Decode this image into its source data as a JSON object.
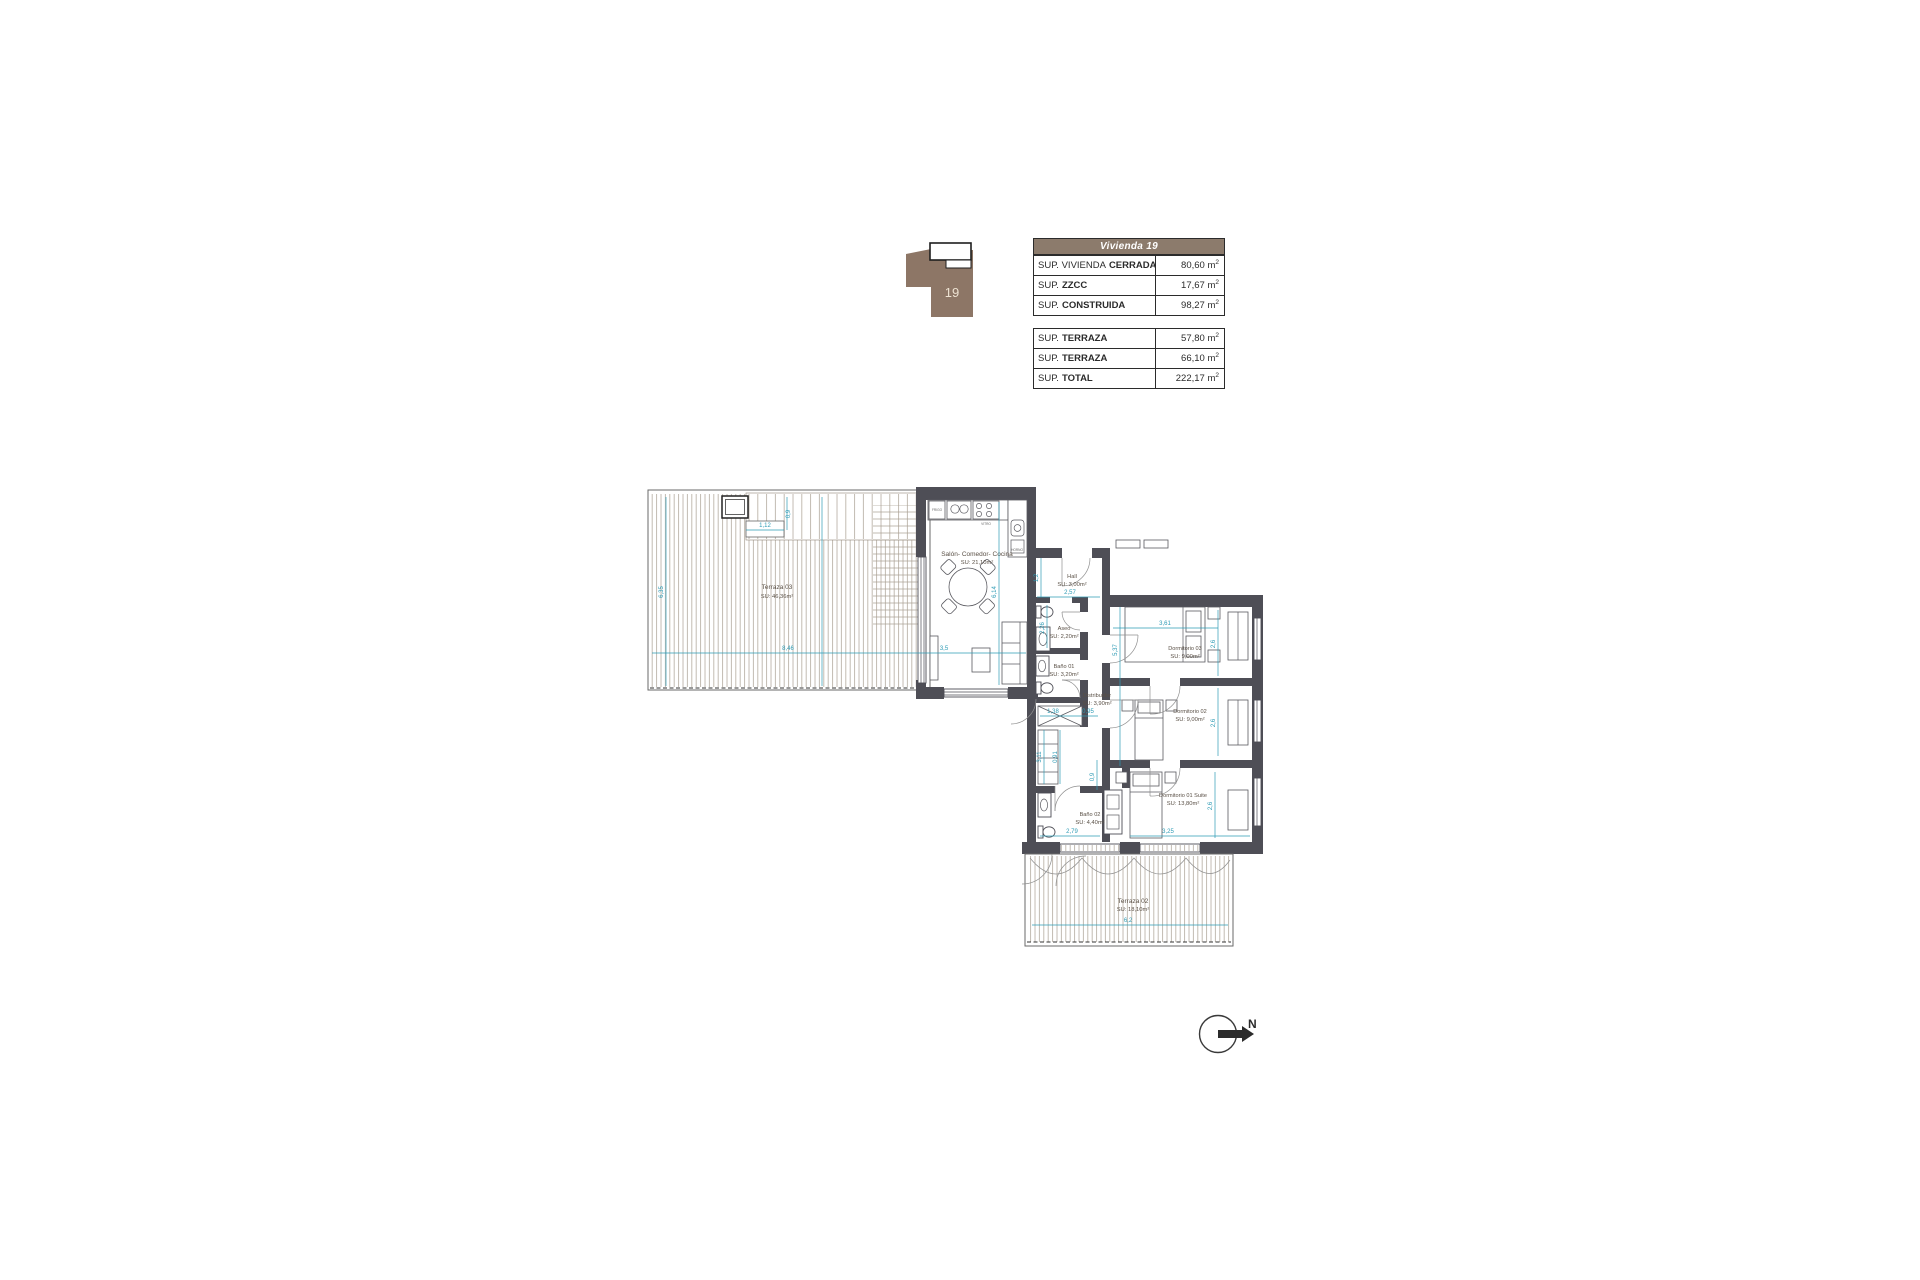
{
  "colors": {
    "header_brown": "#8C7B6C",
    "keyplan_brown": "#8D7666",
    "wall_gray": "#4E4E56",
    "dimension_teal": "#2E9BB5"
  },
  "key_plan": {
    "unit": "19"
  },
  "tables": {
    "main": {
      "header": "Vivienda 19",
      "rows": [
        {
          "label": "SUP. VIVIENDA",
          "label_bold": "CERRADA",
          "value": "80,60 m",
          "exp": "2"
        },
        {
          "label": "SUP.",
          "label_bold": "ZZCC",
          "value": "17,67 m",
          "exp": "2"
        },
        {
          "label": "SUP.",
          "label_bold": "CONSTRUIDA",
          "value": "98,27 m",
          "exp": "2"
        }
      ]
    },
    "terraces": {
      "rows": [
        {
          "label": "SUP.",
          "label_bold": "TERRAZA",
          "value": "57,80 m",
          "exp": "2"
        },
        {
          "label": "SUP.",
          "label_bold": "TERRAZA",
          "value": "66,10 m",
          "exp": "2"
        },
        {
          "label": "SUP.",
          "label_bold": "TOTAL",
          "value": "222,17 m",
          "exp": "2"
        }
      ]
    }
  },
  "floor_plan": {
    "rooms": [
      {
        "name": "Terraza 03",
        "area": "SU: 46,36m²"
      },
      {
        "name": "Salón- Comedor- Cocina",
        "area": "SU: 21,10m²"
      },
      {
        "name": "Hall",
        "area": "SU: 3,00m²"
      },
      {
        "name": "Aseo",
        "area": "SU: 2,20m²"
      },
      {
        "name": "Baño 01",
        "area": "SU: 3,20m²"
      },
      {
        "name": "Distribuidor",
        "area": "SU: 3,90m²"
      },
      {
        "name": "Dormitorio 03",
        "area": "SU: 9,00m²"
      },
      {
        "name": "Dormitorio 02",
        "area": "SU: 9,00m²"
      },
      {
        "name": "Dormitorio 01 Suite",
        "area": "SU: 13,80m²"
      },
      {
        "name": "Baño 02",
        "area": "SU: 4,40m²"
      },
      {
        "name": "Terraza 02",
        "area": "SU: 18,10m²"
      }
    ],
    "dimensions": {
      "terraza3_width": "8,46",
      "terraza3_height": "6,35",
      "notch_width": "1,12",
      "notch_height": "0,9",
      "salon_height": "6,14",
      "salon_width": "3,5",
      "hall_depth": "1,2",
      "hall_width": "2,57",
      "aseo_height": "2,26",
      "wing_height": "5,37",
      "dorm3_width": "3,61",
      "dorm3_height": "2,6",
      "dorm2_height": "2,6",
      "dist_a": "1,38",
      "dist_b": "0,95",
      "corridor_a": "3,11",
      "corridor_b": "0,91",
      "corridor_c": "0,9",
      "bano2_width": "2,79",
      "suite_width": "3,25",
      "suite_height": "2,6",
      "terraza2_width": "6,2"
    },
    "kitchen": {
      "fridge": "FRIGO",
      "hob": "VITRO",
      "oven": "HORNO"
    },
    "compass": {
      "north": "N"
    }
  }
}
